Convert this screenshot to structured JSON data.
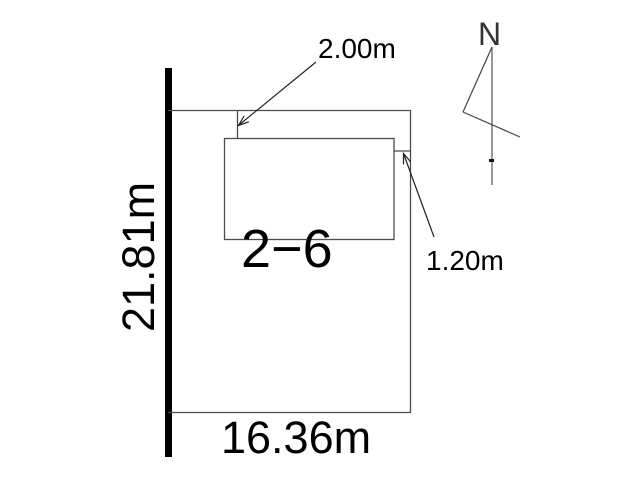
{
  "diagram": {
    "parcel_number": "2−6",
    "dimensions": {
      "left_side": "21.81m",
      "bottom_side": "16.36m",
      "top_setback": "2.00m",
      "right_setback": "1.20m"
    },
    "north": {
      "symbol": "N"
    },
    "colors": {
      "background": "#ffffff",
      "outline": "#4d4d4d",
      "road_boundary": "#000000",
      "arrow": "#222222",
      "text": "#000000"
    }
  }
}
